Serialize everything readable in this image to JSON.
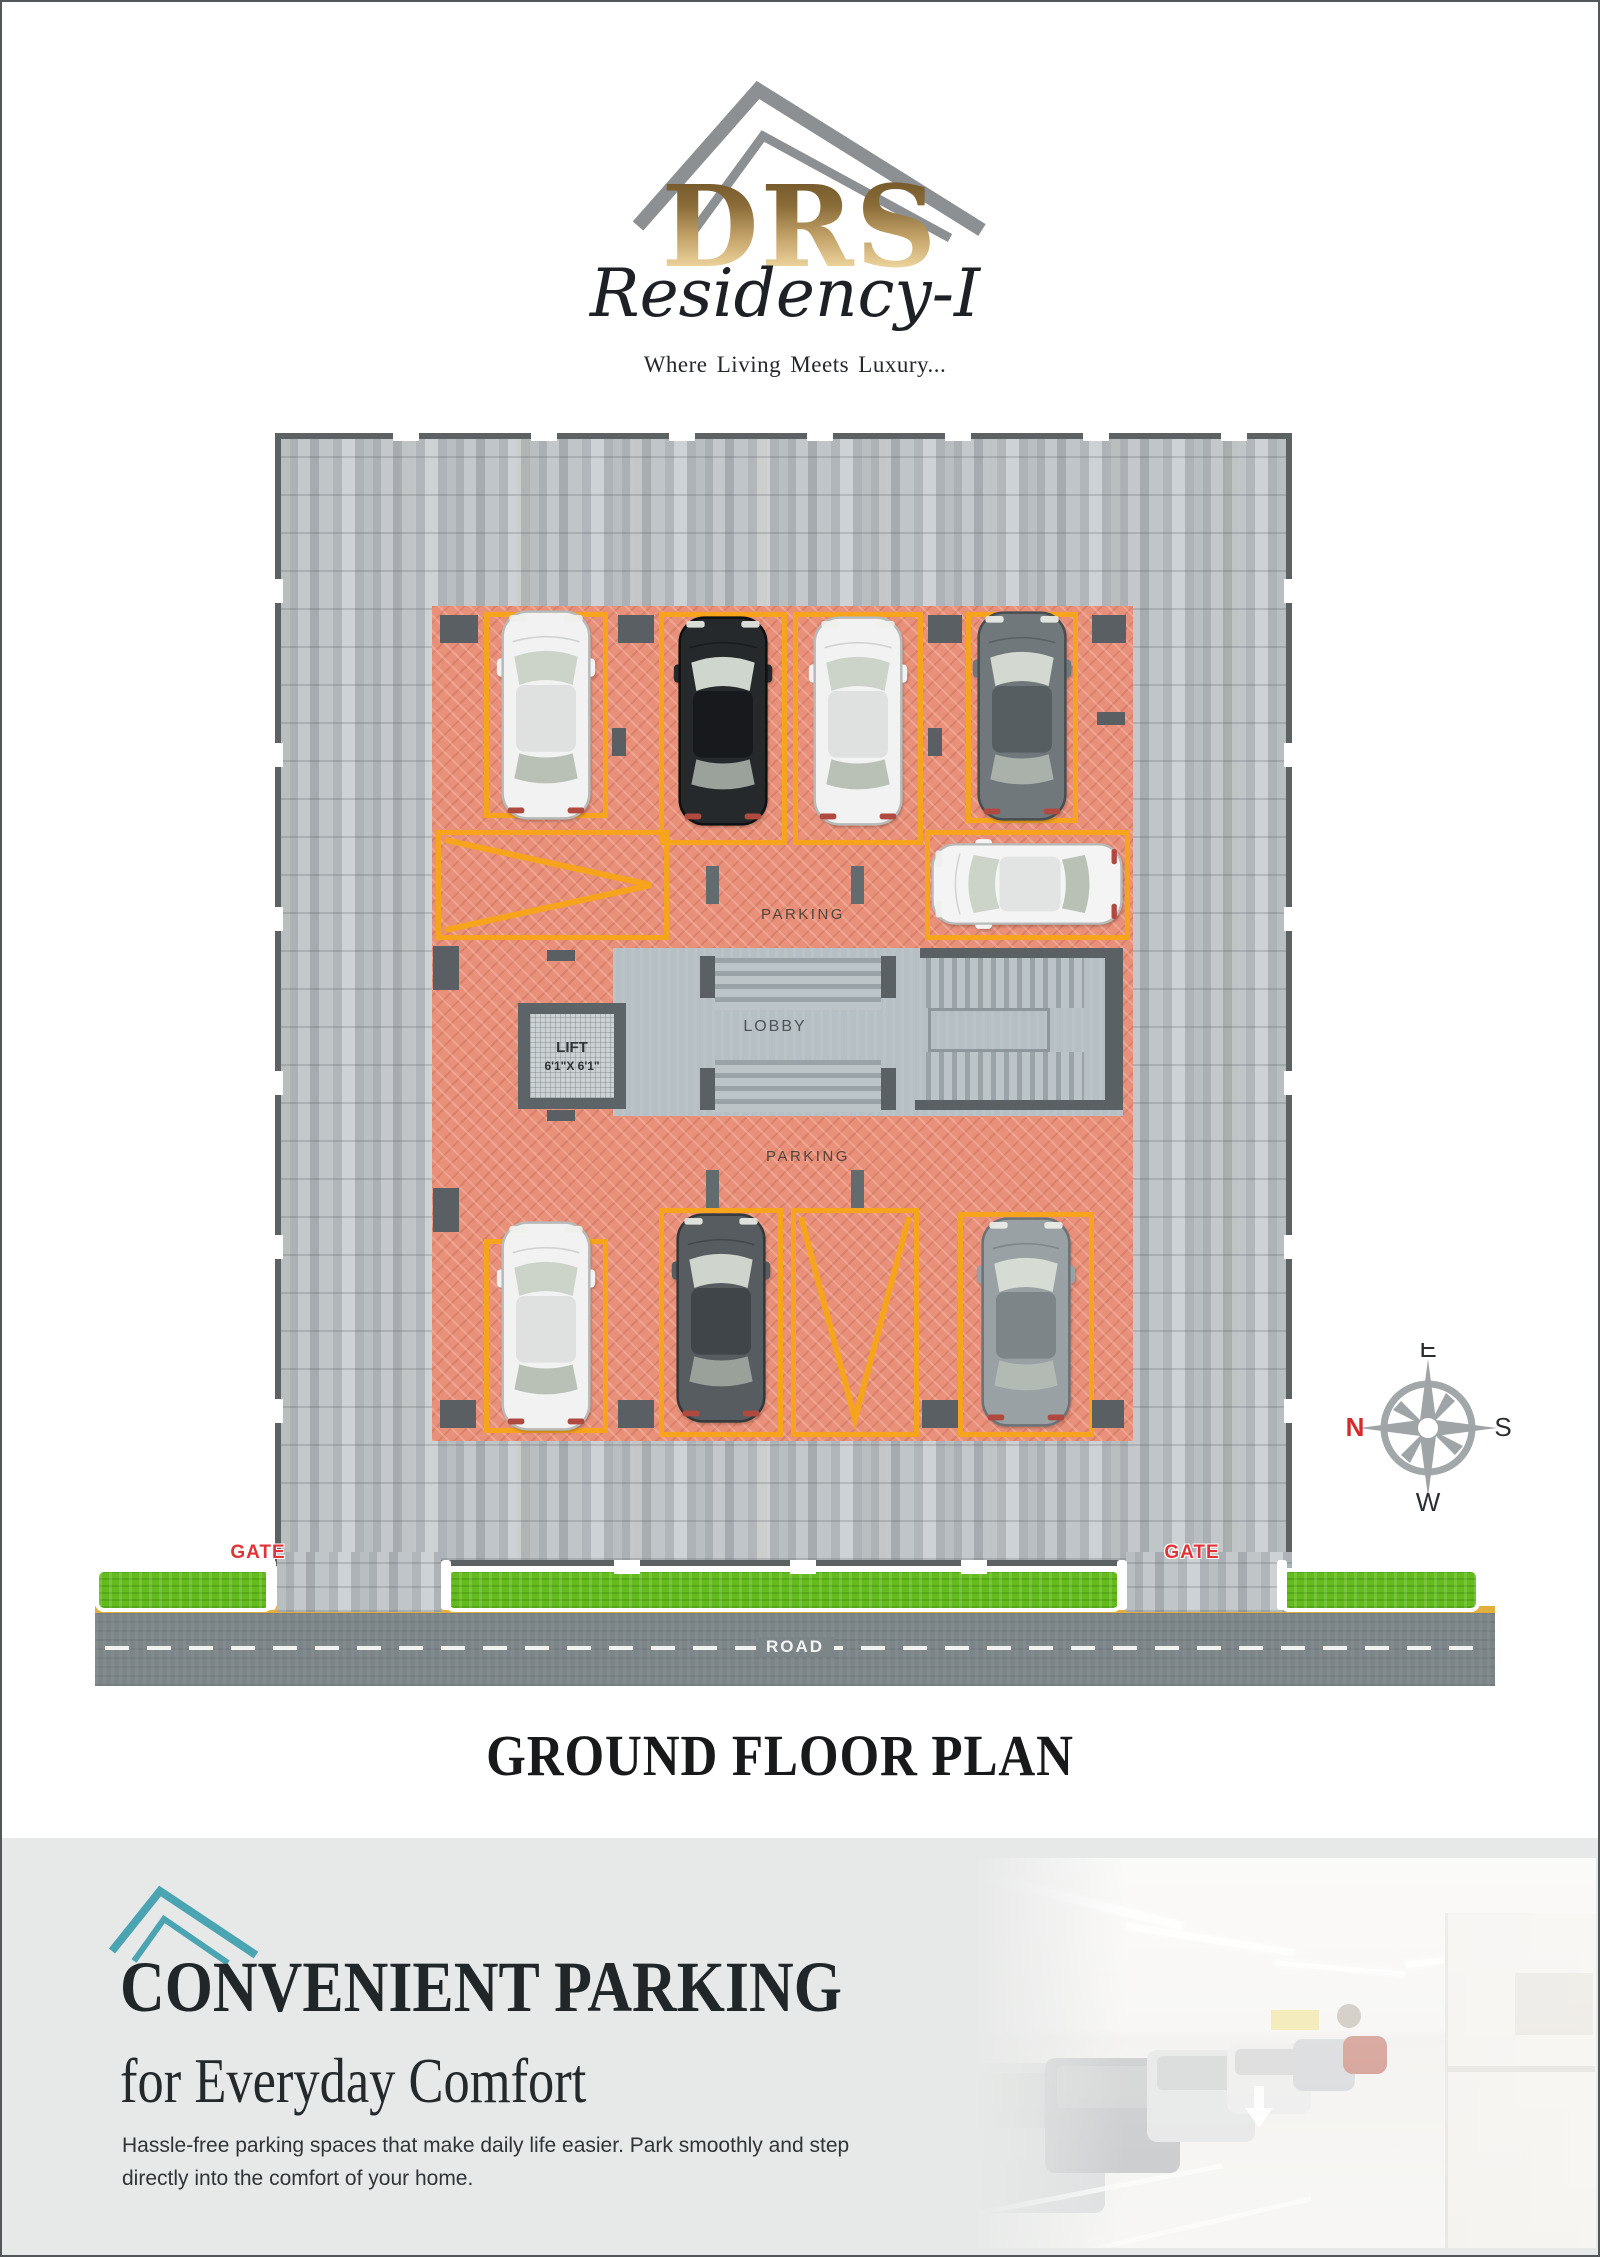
{
  "logo": {
    "drs": "DRS",
    "residency": "Residency-I",
    "tagline": "Where Living Meets Luxury...",
    "roof_color": "#8d9092",
    "gold_top": "#6e5327",
    "gold_bottom": "#ecd49c"
  },
  "plan": {
    "labels": {
      "parking_top": "PARKING",
      "parking_bottom": "PARKING",
      "lobby": "LOBBY",
      "lift_line1": "LIFT",
      "lift_line2": "6'1\"X 6'1\"",
      "gate_left": "GATE",
      "gate_right": "GATE",
      "road": "ROAD"
    },
    "compass": {
      "top": "E",
      "right": "S",
      "bottom": "W",
      "left": "N",
      "north_color": "#d42b2b",
      "rose_color": "#9fa4a7"
    },
    "colors": {
      "space_outline": "#f6a41c",
      "parking_floor": "#e8907a",
      "paver": "#b5babd",
      "grass": "#63bb1e",
      "road_yellow": "#e2ae3c",
      "gate_red": "#e03338"
    },
    "cars": [
      {
        "space": "top-1",
        "body": "#f1f2f1",
        "roof": "#dfe1e0",
        "edge": "#b7bab8",
        "glass": "#ccd3c8",
        "glass2": "#b9c1b7"
      },
      {
        "space": "top-2",
        "body": "#26292c",
        "roof": "#17191c",
        "edge": "#0e1012",
        "glass": "#cfd6cd",
        "glass2": "#9aa29b"
      },
      {
        "space": "top-3",
        "body": "#f1f2f1",
        "roof": "#dfe1e0",
        "edge": "#b7bab8",
        "glass": "#ccd3c8",
        "glass2": "#b9c1b7"
      },
      {
        "space": "top-4",
        "body": "#70787c",
        "roof": "#565e62",
        "edge": "#474e52",
        "glass": "#d3d9d0",
        "glass2": "#aab1ab"
      },
      {
        "space": "middle-right",
        "body": "#f3f4f3",
        "roof": "#e2e4e3",
        "edge": "#b7bab8",
        "glass": "#ccd3c8",
        "glass2": "#b9c1b7"
      },
      {
        "space": "bottom-1",
        "body": "#f1f2f1",
        "roof": "#dfe1e0",
        "edge": "#b7bab8",
        "glass": "#ccd3c8",
        "glass2": "#b9c1b7"
      },
      {
        "space": "bottom-2",
        "body": "#565c60",
        "roof": "#3f4549",
        "edge": "#33383b",
        "glass": "#cfd5cc",
        "glass2": "#9aa19b"
      },
      {
        "space": "bottom-4",
        "body": "#9aa1a4",
        "roof": "#7e8589",
        "edge": "#6b7276",
        "glass": "#d6dcd3",
        "glass2": "#b3bab3"
      }
    ]
  },
  "title": "GROUND FLOOR PLAN",
  "footer": {
    "heading_line1": "CONVENIENT PARKING",
    "heading_line2": "for Everyday Comfort",
    "body": "Hassle-free parking spaces that make daily life easier. Park smoothly and step directly into the comfort of your home.",
    "accent_color": "#4aa4b2"
  }
}
